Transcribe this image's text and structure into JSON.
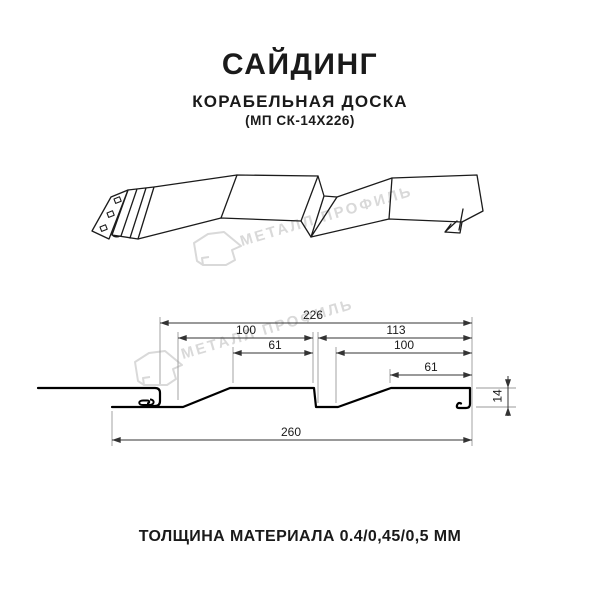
{
  "header": {
    "title": "САЙДИНГ",
    "subtitle": "КОРАБЕЛЬНАЯ ДОСКА",
    "model": "(МП СК-14Х226)"
  },
  "watermark": {
    "brand_text": "МЕТАЛЛ ПРОФИЛЬ",
    "color": "#d9d9d9"
  },
  "cross_section": {
    "dimensions_mm": {
      "profile_visible_width": "226",
      "board_pitch_left": "100",
      "board_pitch_right": "113",
      "board_flat_left": "61",
      "board_flat_right_pitch": "100",
      "board_flat_right": "61",
      "total_width": "260",
      "profile_height": "14"
    }
  },
  "footer": {
    "thickness_note": "ТОЛЩИНА МАТЕРИАЛА 0.4/0,45/0,5 ММ"
  },
  "colors": {
    "line": "#1a1a1a",
    "dimension_line": "#333333",
    "extension_line": "#999999",
    "watermark": "#d9d9d9",
    "background": "#ffffff"
  }
}
